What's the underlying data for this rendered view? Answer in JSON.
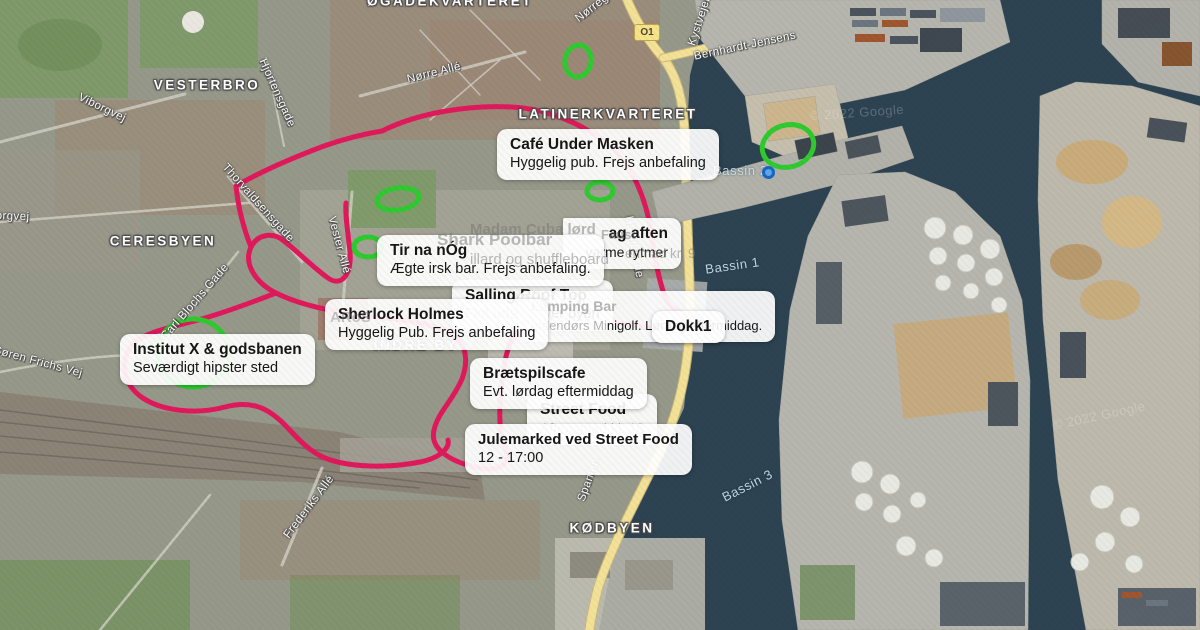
{
  "colors": {
    "route": "#e0195c",
    "highlight-green": "#2fca2f",
    "water": "#2d4352",
    "land": "#96998a",
    "pier": "#b6b6ae",
    "road-yellow": "#f3e198",
    "callout-bg": "rgba(255,255,255,0.93)"
  },
  "map": {
    "attribution": "© 2022 Google",
    "area_labels": {
      "ogadekvarteret": "ØGADEKVARTERET",
      "vesterbro": "VESTERBRO",
      "latinerkvarteret": "LATINERKVARTERET",
      "ceresbyen": "CERESBYEN",
      "indre_by": "INDRE BY",
      "kodbyen": "KØDBYEN"
    },
    "water_labels": {
      "bassin1": "Bassin 1",
      "bassin2": "Bassin 2",
      "bassin3": "Bassin 3"
    },
    "roads": {
      "ring_badge": "O1",
      "norregade": "Nørregade",
      "kystvejen": "Kystvejen",
      "bernhardt_jensens": "Bernhardt-Jensens",
      "norre_alle": "Nørre Allé",
      "hjortensgade": "Hjortensgade",
      "viborgvej": "Viborgvej",
      "silkeborgvej": "Silkeborgvej",
      "thorvaldsensgade": "Thorvaldsensgade",
      "vester_alle": "Vester Allé",
      "carl_blochs_gade": "Carl Blochs Gade",
      "soren_frichs_vej": "Søren Frichs Vej",
      "frederiks_alle": "Frederiks Allé",
      "spanien": "Spanien",
      "havnegade": "Havnegade"
    }
  },
  "callouts": {
    "cafe_under_masken": {
      "title": "Café Under Masken",
      "subtitle": "Hyggelig pub. Frejs anbefaling"
    },
    "madam_cuba_fragment": {
      "title": "ag aften",
      "subtitle": "varme rytmer"
    },
    "tir_na_nog": {
      "title": "Tir na nÓg",
      "subtitle": "Ægte irsk bar. Frejs anbefaling."
    },
    "salling_roof_top": {
      "title": "Salling Roof Top",
      "subtitle_faded": "Flot udsi",
      "subtitle": "gt over byen"
    },
    "minigolf_fragment": {
      "title_faded": "Lamping Bar",
      "subtitle_faded": "Indendørs Mi",
      "subtitle": "nigolf. Lørdag eftermiddag."
    },
    "sherlock_holmes": {
      "title": "Sherlock Holmes",
      "subtitle": "Hyggelig Pub. Frejs anbefaling"
    },
    "dokk1": {
      "title": "Dokk1"
    },
    "institut_x": {
      "title": "Institut X & godsbanen",
      "subtitle": "Seværdigt hipster sted"
    },
    "braetspilscafe": {
      "title": "Brætspilscafe",
      "subtitle": "Evt. lørdag eftermiddag"
    },
    "street_food": {
      "title": "Street Food",
      "subtitle_faded": "Aftensmad kl. 18"
    },
    "julemarked": {
      "title": "Julemarked ved Street Food",
      "subtitle": "12 - 17:00"
    }
  },
  "ghost_labels": {
    "madam_cuba": "Madam Cuba lørd",
    "faust": "Faust",
    "shark_poolbar": "Shark Poolbar",
    "shark_poolbar_sub": "illard og shuffleboard",
    "smorrebrod": "enmad kr. 9",
    "aros": "ARoS"
  }
}
